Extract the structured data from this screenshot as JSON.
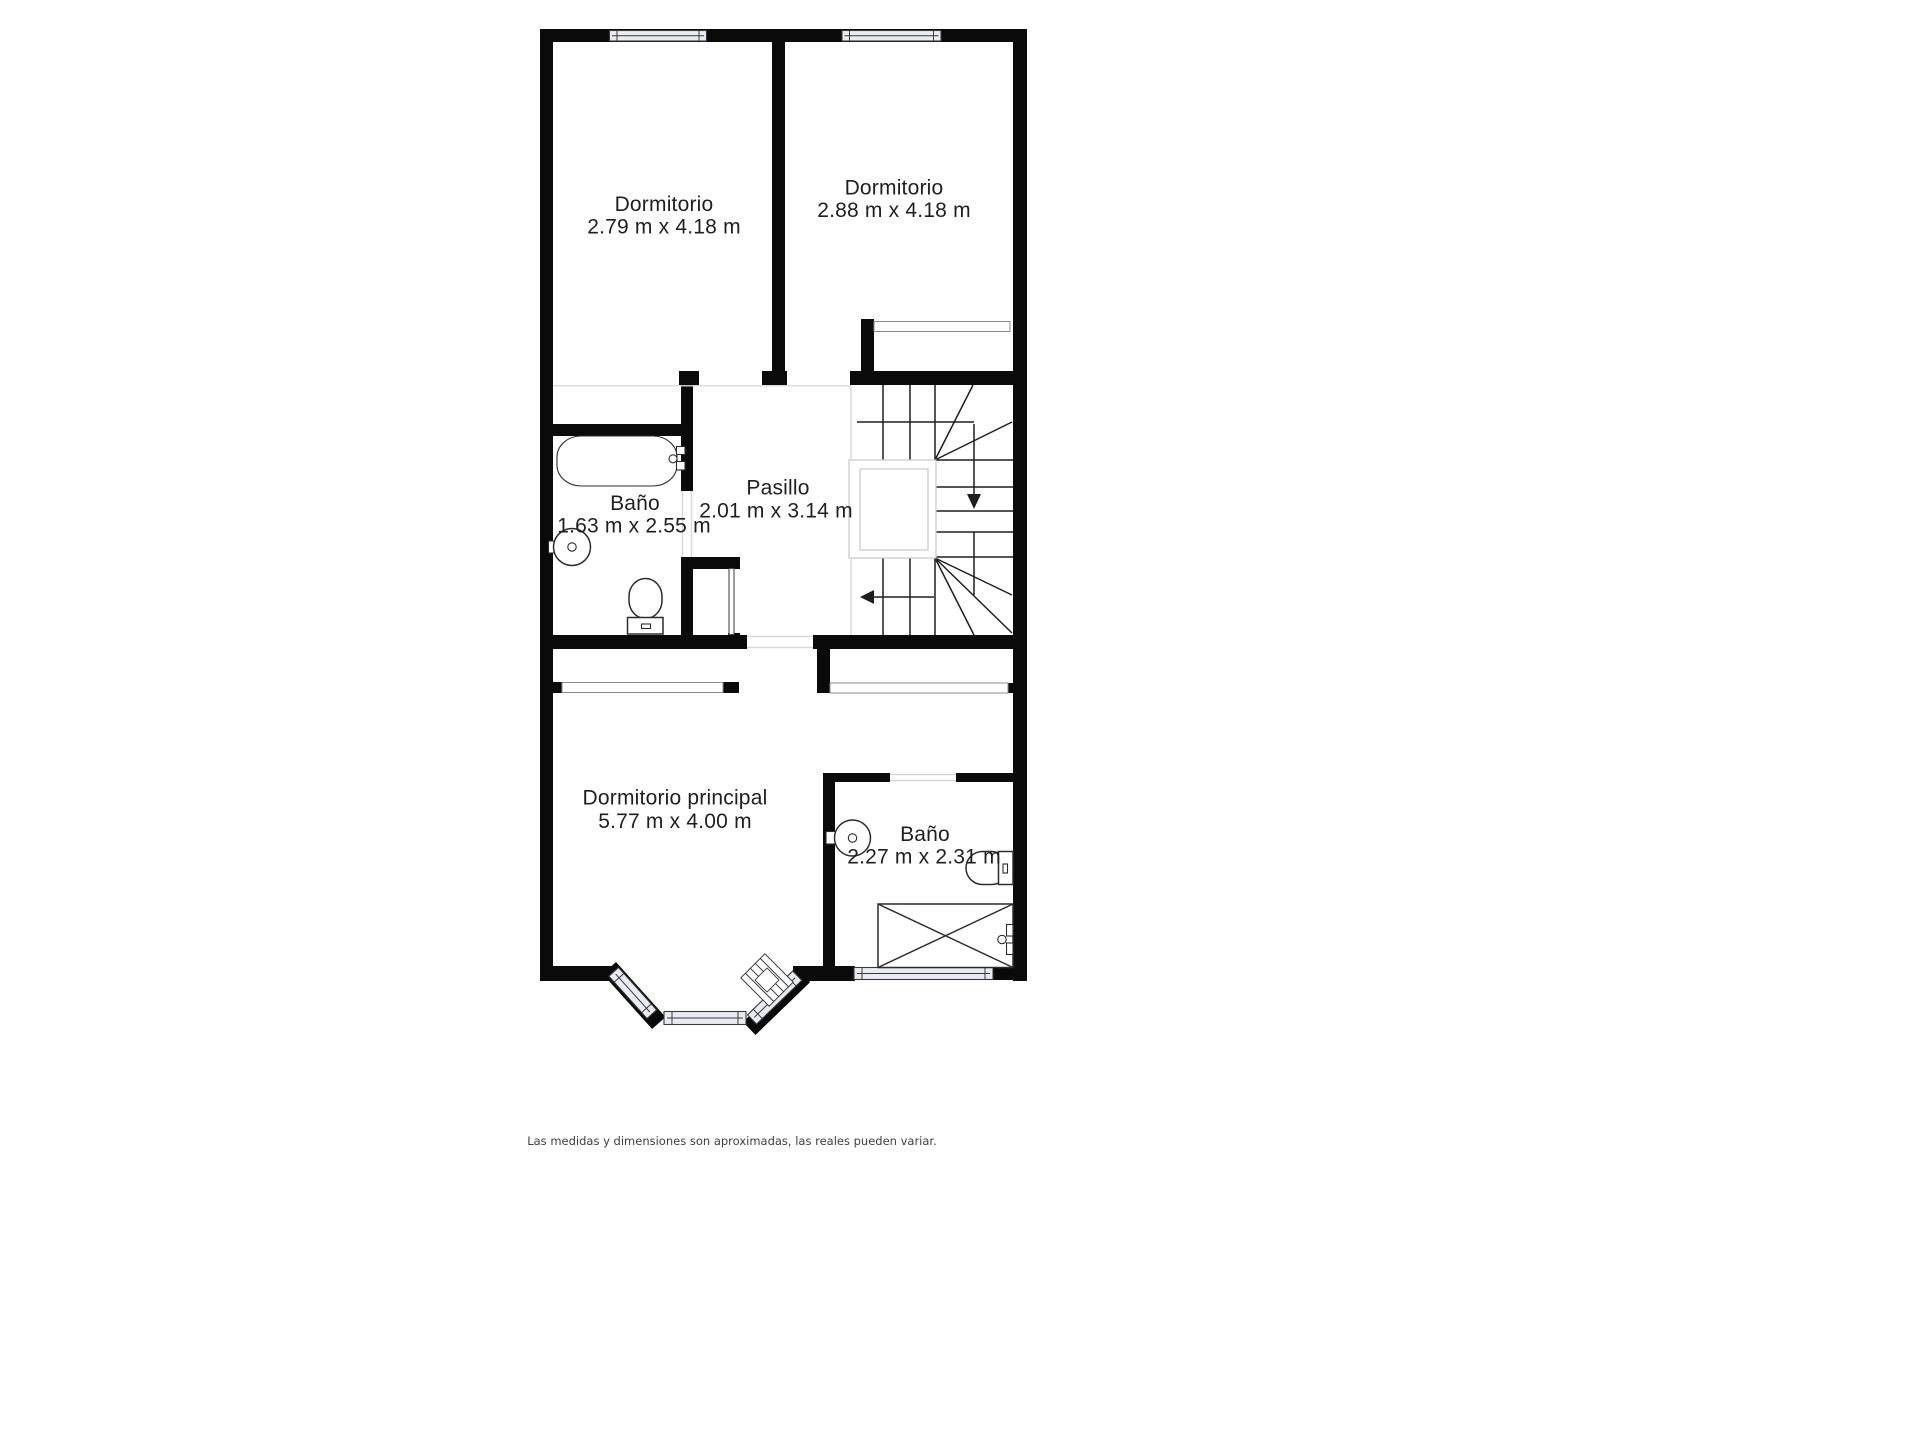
{
  "plan": {
    "rooms": [
      {
        "id": "dormitorio-1",
        "label": "Dormitorio",
        "dims": "2.79 m x 4.18 m"
      },
      {
        "id": "dormitorio-2",
        "label": "Dormitorio",
        "dims": "2.88 m x 4.18 m"
      },
      {
        "id": "banio-1",
        "label": "Baño",
        "dims": "1.63 m x 2.55 m"
      },
      {
        "id": "pasillo",
        "label": "Pasillo",
        "dims": "2.01 m x 3.14 m"
      },
      {
        "id": "dormitorio-principal",
        "label": "Dormitorio principal",
        "dims": "5.77 m x 4.00 m"
      },
      {
        "id": "banio-2",
        "label": "Baño",
        "dims": "2.27 m x 2.31 m"
      }
    ],
    "colors": {
      "wall": "#0a0a0a",
      "window_fill": "#e9ebf3",
      "boundary": "#d8d8d8",
      "text": "#1f1f1f",
      "disclaimer": "#3f3f3f"
    }
  },
  "footer": {
    "disclaimer": "Las medidas y dimensiones son aproximadas, las reales pueden variar."
  }
}
